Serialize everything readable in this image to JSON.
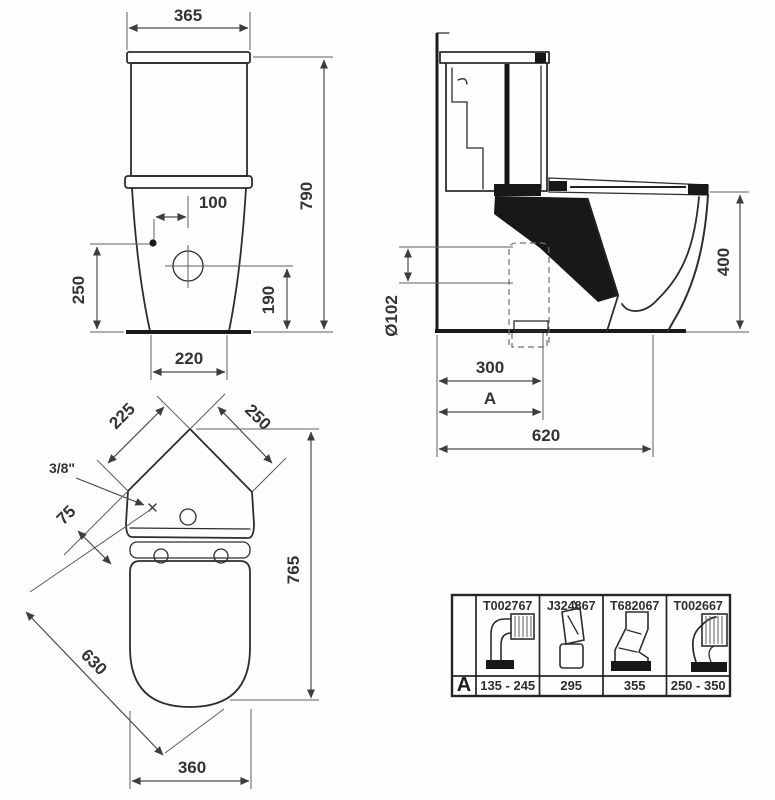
{
  "drawing": {
    "description": "Corner close-coupled WC technical dimension drawing",
    "line_color": "#2d2d2d",
    "background": "#fefefe",
    "front_view": {
      "cistern_width": "365",
      "total_height": "790",
      "inlet_offset": "100",
      "inlet_height": "250",
      "fixing_height": "190",
      "base_width": "220"
    },
    "side_view": {
      "rim_height": "400",
      "outlet_diameter": "Ø102",
      "outlet_setout": "300",
      "adjustable_setout": "A",
      "total_depth": "620"
    },
    "plan_view": {
      "edge_left": "225",
      "edge_right": "250",
      "inlet_thread": "3/8\"",
      "inlet_edge_offset": "75",
      "total_length": "765",
      "diagonal_length": "630",
      "seat_width": "360"
    },
    "table": {
      "row_header": "A",
      "columns": [
        {
          "part_no": "T002767",
          "dim_a": "135 - 245",
          "icon": "elbow-ribbed-outlet-icon"
        },
        {
          "part_no": "J324867",
          "dim_a": "295",
          "icon": "straight-connector-icon"
        },
        {
          "part_no": "T682067",
          "dim_a": "355",
          "icon": "offset-s-connector-icon"
        },
        {
          "part_no": "T002667",
          "dim_a": "250 - 350",
          "icon": "elbow-base-connector-icon"
        }
      ]
    }
  }
}
